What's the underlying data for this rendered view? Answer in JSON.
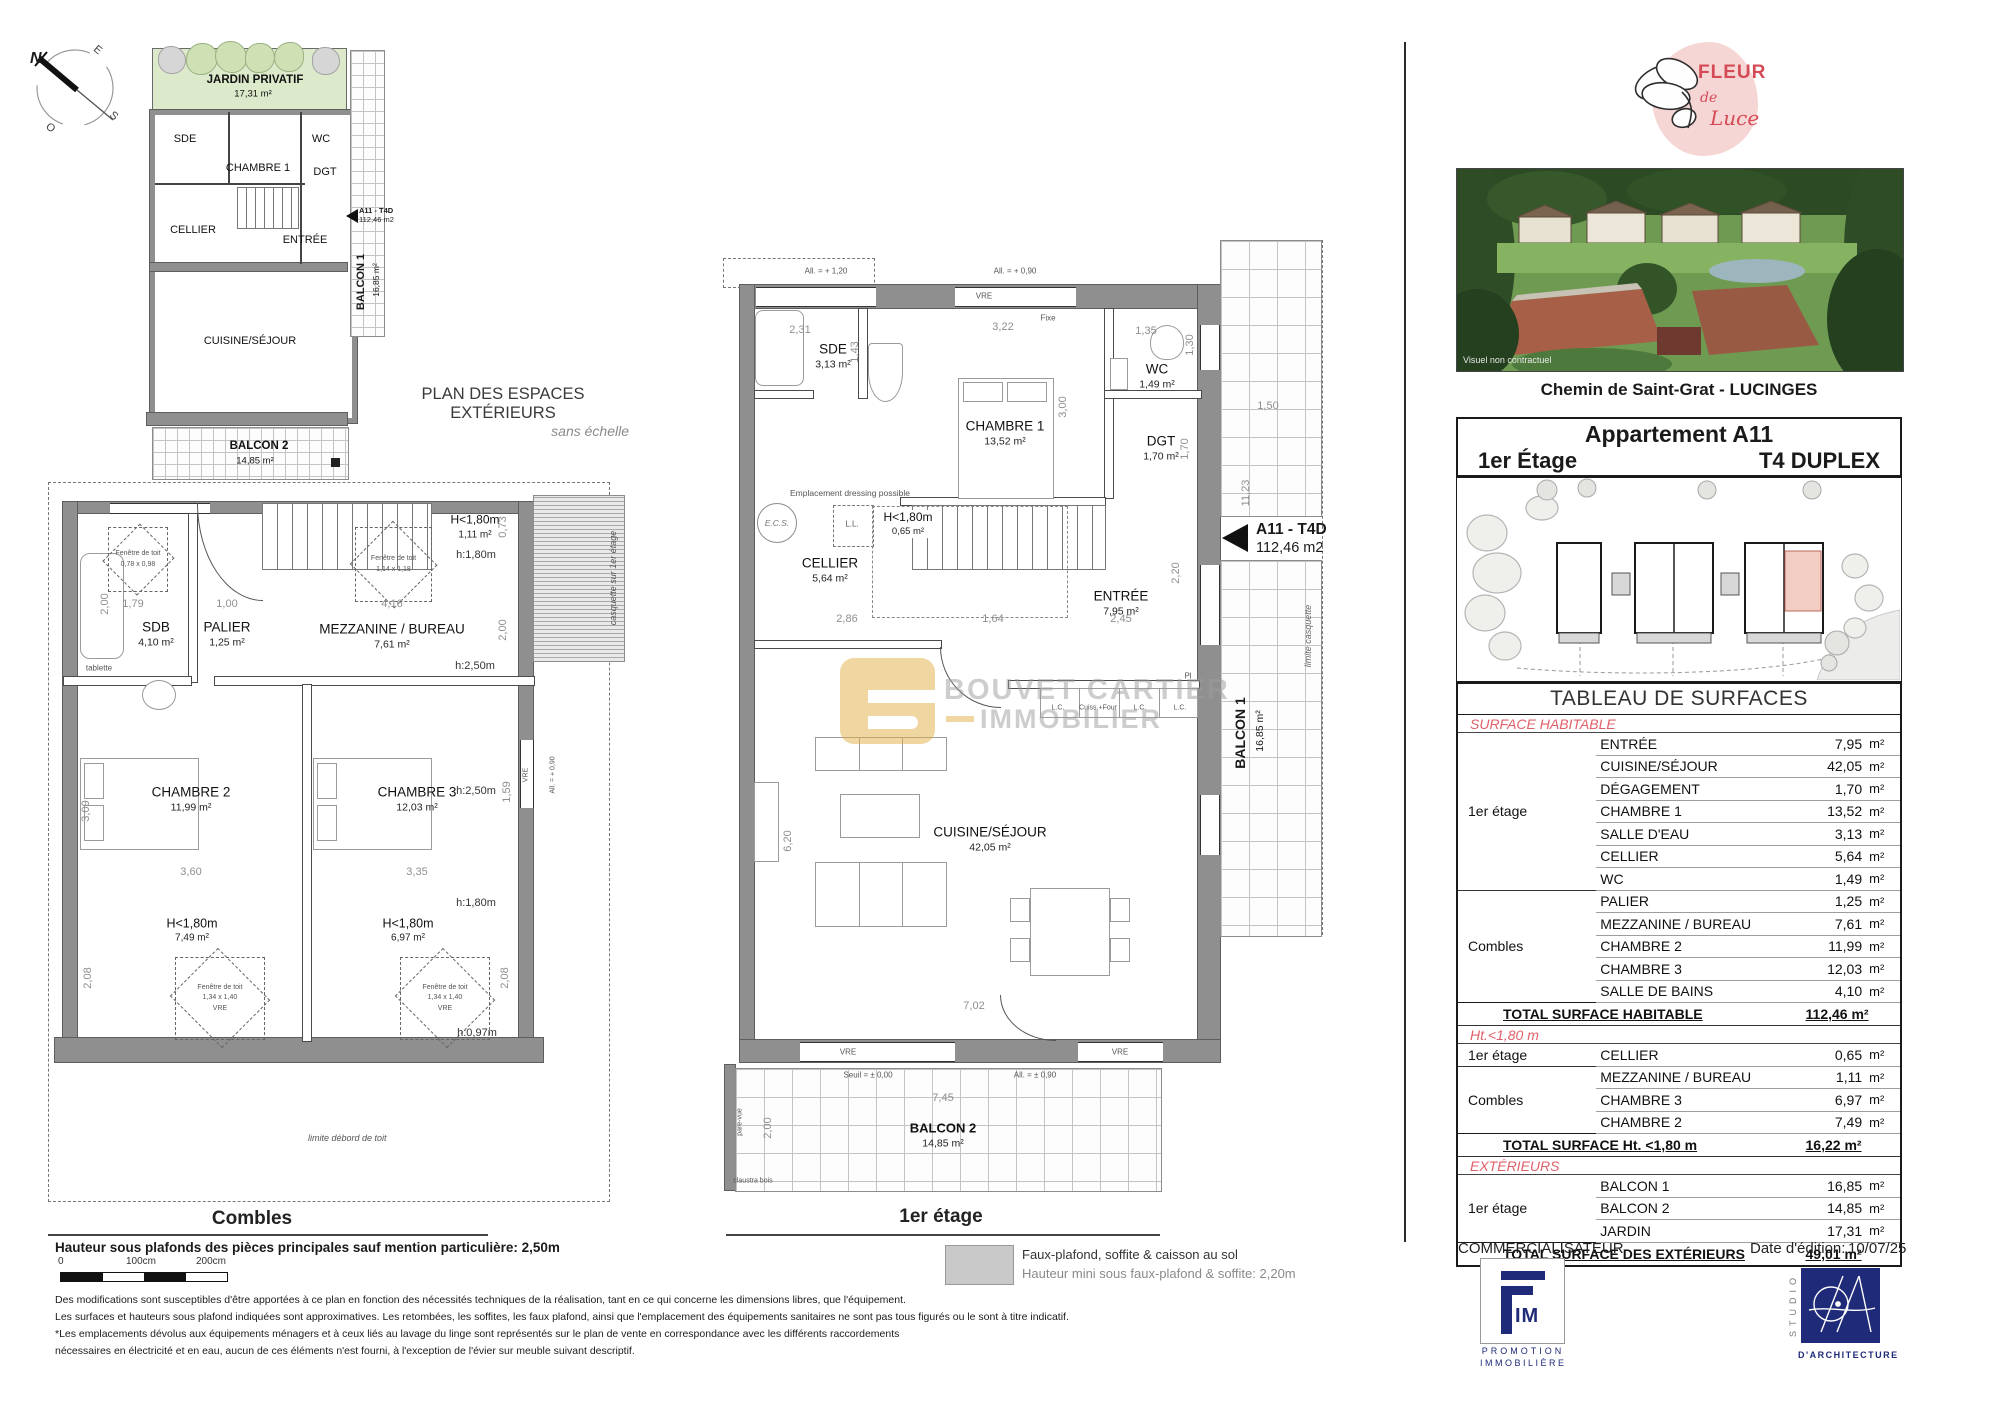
{
  "compass": {
    "n": "N",
    "e": "E",
    "s": "S",
    "o": "O"
  },
  "exterior": {
    "caption": "PLAN DES ESPACES EXTÉRIEURS",
    "caption_sub": "sans échelle",
    "jardin": {
      "name": "JARDIN PRIVATIF",
      "area": "17,31 m²"
    },
    "rooms": {
      "sde": "SDE",
      "ch1": "CHAMBRE 1",
      "wc": "WC",
      "dgt": "DGT",
      "cellier": "CELLIER",
      "entree": "ENTRÉE",
      "cuisine": "CUISINE/SÉJOUR"
    },
    "balcon1": {
      "name": "BALCON 1",
      "area": "16,85 m²"
    },
    "balcon2": {
      "name": "BALCON 2",
      "area": "14,85 m²"
    },
    "unit": {
      "code": "A11 - T4D",
      "area": "112,46 m2"
    }
  },
  "combles": {
    "label": "Combles",
    "rooms": {
      "sdb": {
        "name": "SDB",
        "area": "4,10 m²"
      },
      "palier": {
        "name": "PALIER",
        "area": "1,25 m²"
      },
      "mezz": {
        "name": "MEZZANINE / BUREAU",
        "area": "7,61 m²"
      },
      "ch2": {
        "name": "CHAMBRE 2",
        "area": "11,99 m²"
      },
      "ch3": {
        "name": "CHAMBRE 3",
        "area": "12,03 m²"
      }
    },
    "low1": {
      "name": "H<1,80m",
      "area": "1,11 m²"
    },
    "low2": {
      "name": "H<1,80m",
      "area": "7,49 m²"
    },
    "low3": {
      "name": "H<1,80m",
      "area": "6,97 m²"
    },
    "h180": "h:1,80m",
    "h250": "h:2,50m",
    "h097": "h:0,97m",
    "tablette": "tablette",
    "casquette": "casquette sur 1er étage",
    "limite": "limite débord de toit",
    "fdt1": {
      "l1": "Fenêtre de toit",
      "l2": "0,78 x 0,98"
    },
    "fdt2": {
      "l1": "Fenêtre de toit",
      "l2": "1,14 x 1,18",
      "l3": "VRE"
    },
    "fdt3": {
      "l1": "Fenêtre de toit",
      "l2": "1,34 x 1,40",
      "l3": "VRE"
    },
    "vre": "VRE",
    "all090": "All. = + 0,90",
    "dims": {
      "d200a": "2,00",
      "d179": "1,79",
      "d100": "1,00",
      "d416": "4,16",
      "d073": "0,73",
      "d200b": "2,00",
      "d309": "3,09",
      "d159": "1,59",
      "d360": "3,60",
      "d335": "3,35",
      "d208a": "2,08",
      "d208b": "2,08"
    }
  },
  "etage": {
    "label": "1er étage",
    "rooms": {
      "sde": {
        "name": "SDE",
        "area": "3,13 m²"
      },
      "ch1": {
        "name": "CHAMBRE 1",
        "area": "13,52 m²"
      },
      "wc": {
        "name": "WC",
        "area": "1,49 m²"
      },
      "dgt": {
        "name": "DGT",
        "area": "1,70 m²"
      },
      "cellier": {
        "name": "CELLIER",
        "area": "5,64 m²"
      },
      "entree": {
        "name": "ENTRÉE",
        "area": "7,95 m²"
      },
      "cuisine": {
        "name": "CUISINE/SÉJOUR",
        "area": "42,05 m²"
      },
      "balcon1": {
        "name": "BALCON 1",
        "area": "16,85 m²"
      },
      "balcon2": {
        "name": "BALCON 2",
        "area": "14,85 m²"
      }
    },
    "low": {
      "name": "H<1,80m",
      "area": "0,65 m²"
    },
    "unit": {
      "code": "A11 - T4D",
      "area": "112,46 m2"
    },
    "ann": {
      "all120": "All. = + 1,20",
      "all090": "All. = + 0,90",
      "vre": "VRE",
      "fixe": "Fixe",
      "dressing": "Emplacement dressing possible",
      "ecs": "E.C.S.",
      "ll": "L.L.",
      "pl": "Pl",
      "lc": "L.C.",
      "cuiss": "Cuiss.+Four",
      "seuil": "Seuil = ± 0,00",
      "all090b": "All. = ± 0,90",
      "parevue": "pare-vue",
      "claustra": "claustra bois",
      "limite": "limite casquette"
    },
    "dims": {
      "d231": "2,31",
      "d143": "1,43",
      "d322": "3,22",
      "d300": "3,00",
      "d135": "1,35",
      "d130": "1,30",
      "d170": "1,70",
      "d286": "2,86",
      "d164": "1,64",
      "d245": "2,45",
      "d220": "2,20",
      "d620": "6,20",
      "d702": "7,02",
      "d745": "7,45",
      "d200": "2,00",
      "d150": "1,50",
      "d1123": "11,23"
    }
  },
  "watermark": {
    "line1": "BOUVET CARTIER",
    "line2": "IMMOBILIER"
  },
  "legend": {
    "line1": "Faux-plafond, soffite & caisson au sol",
    "line2": "Hauteur mini sous faux-plafond & soffite: 2,20m"
  },
  "notes": {
    "bold": "Hauteur sous plafonds des pièces principales sauf mention particulière: 2,50m",
    "footnotes": [
      "Des modifications sont susceptibles d'être apportées à ce plan en fonction des nécessités techniques de la réalisation, tant en ce qui concerne les dimensions libres, que l'équipement.",
      "Les surfaces et hauteurs sous plafond indiquées sont approximatives. Les retombées, les soffites, les faux plafond, ainsi que l'emplacement des équipements sanitaires ne sont pas tous figurés ou le sont à titre indicatif.",
      "*Les emplacements dévolus aux équipements ménagers et à ceux liés au lavage du linge sont représentés sur le plan de vente en correspondance avec les différents raccordements",
      "nécessaires en électricité et en eau, aucun de ces éléments n'est fourni, à l'exception de l'évier sur meuble suivant descriptif."
    ]
  },
  "scalebar": {
    "t0": "0",
    "t1": "100cm",
    "t2": "200cm"
  },
  "panel": {
    "brand": {
      "w1": "FLEUR",
      "w2": "de",
      "w3": "Luce"
    },
    "photo_note": "Visuel non contractuel",
    "address": "Chemin de Saint-Grat - LUCINGES",
    "header": {
      "title": "Appartement A11",
      "floor": "1er Étage",
      "type": "T4 DUPLEX"
    },
    "table": {
      "title": "TABLEAU DE SURFACES",
      "unit": "m²",
      "s1": {
        "name": "SURFACE HABITABLE",
        "g1": {
          "label": "1er étage",
          "rows": [
            {
              "label": "ENTRÉE",
              "value": "7,95"
            },
            {
              "label": "CUISINE/SÉJOUR",
              "value": "42,05"
            },
            {
              "label": "DÉGAGEMENT",
              "value": "1,70"
            },
            {
              "label": "CHAMBRE 1",
              "value": "13,52"
            },
            {
              "label": "SALLE D'EAU",
              "value": "3,13"
            },
            {
              "label": "CELLIER",
              "value": "5,64"
            },
            {
              "label": "WC",
              "value": "1,49"
            }
          ]
        },
        "g2": {
          "label": "Combles",
          "rows": [
            {
              "label": "PALIER",
              "value": "1,25"
            },
            {
              "label": "MEZZANINE / BUREAU",
              "value": "7,61"
            },
            {
              "label": "CHAMBRE 2",
              "value": "11,99"
            },
            {
              "label": "CHAMBRE 3",
              "value": "12,03"
            },
            {
              "label": "SALLE DE BAINS",
              "value": "4,10"
            }
          ]
        },
        "total": {
          "label": "TOTAL SURFACE HABITABLE",
          "value": "112,46 m²"
        }
      },
      "s2": {
        "name": "Ht.<1,80 m",
        "g1": {
          "label": "1er étage",
          "rows": [
            {
              "label": "CELLIER",
              "value": "0,65"
            }
          ]
        },
        "g2": {
          "label": "Combles",
          "rows": [
            {
              "label": "MEZZANINE / BUREAU",
              "value": "1,11"
            },
            {
              "label": "CHAMBRE 3",
              "value": "6,97"
            },
            {
              "label": "CHAMBRE 2",
              "value": "7,49"
            }
          ]
        },
        "total": {
          "label": "TOTAL SURFACE Ht. <1,80 m",
          "value": "16,22 m²"
        }
      },
      "s3": {
        "name": "EXTÉRIEURS",
        "g1": {
          "label": "1er étage",
          "rows": [
            {
              "label": "BALCON 1",
              "value": "16,85"
            },
            {
              "label": "BALCON 2",
              "value": "14,85"
            },
            {
              "label": "JARDIN",
              "value": "17,31"
            }
          ]
        },
        "total": {
          "label": "TOTAL SURFACE  DES EXTÉRIEURS",
          "value": "49,01 m²"
        }
      }
    },
    "commercial": "COMMERCIALISATEUR",
    "date_label": "Date d'édition:",
    "date_value": "10/07/25",
    "fim": {
      "letters": "IM",
      "sub1": "PROMOTION",
      "sub2": "IMMOBILIÈRE"
    },
    "studio": {
      "vertical": "STUDIO",
      "sub": "D'ARCHITECTURE"
    }
  }
}
